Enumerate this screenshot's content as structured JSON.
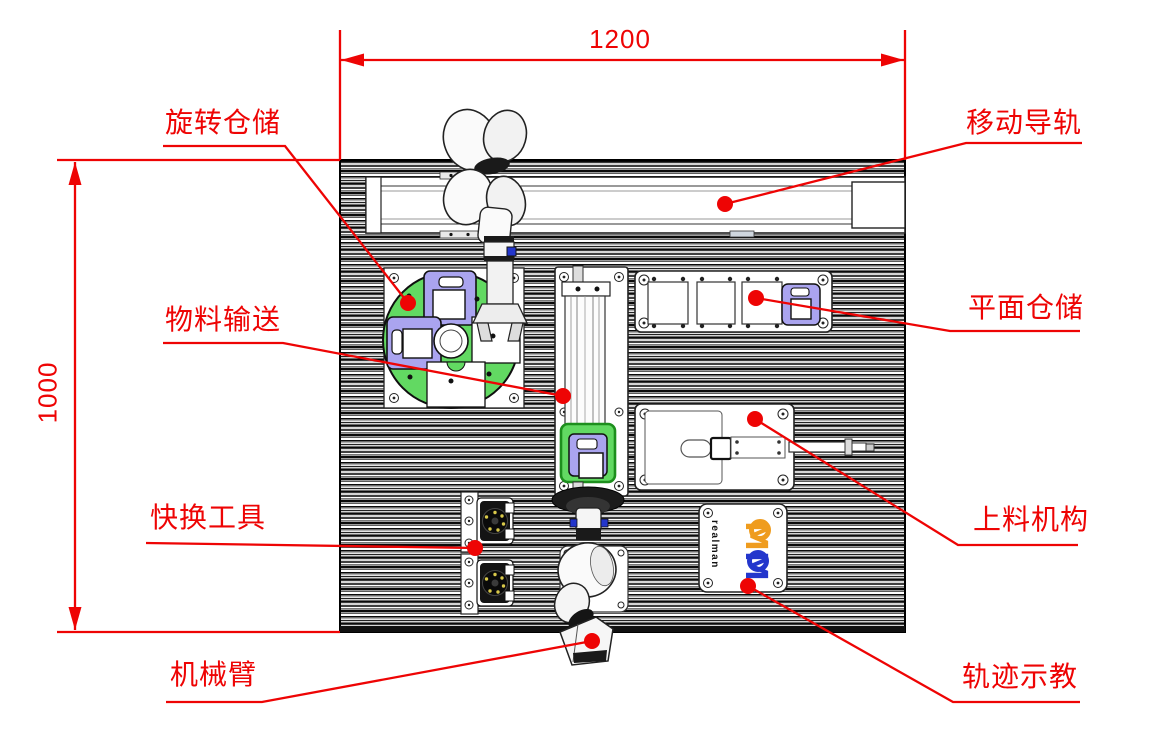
{
  "diagram": {
    "dimensions": {
      "width": "1200",
      "height": "1000"
    },
    "labels": {
      "rotary_storage": "旋转仓储",
      "moving_rail": "移动导轨",
      "material_conveying": "物料输送",
      "planar_storage": "平面仓储",
      "quick_change_tool": "快换工具",
      "loading_mechanism": "上料机构",
      "robot_arm": "机械臂",
      "trajectory_teaching": "轨迹示教"
    },
    "brand": "realman",
    "colors": {
      "annotation_red": "#ee0404",
      "disc_green": "#62d962",
      "module_purple": "#aaa4ef",
      "module_green_border": "#1d8f1d",
      "logo_orange": "#ef9c1e",
      "logo_blue": "#2336cc"
    }
  }
}
